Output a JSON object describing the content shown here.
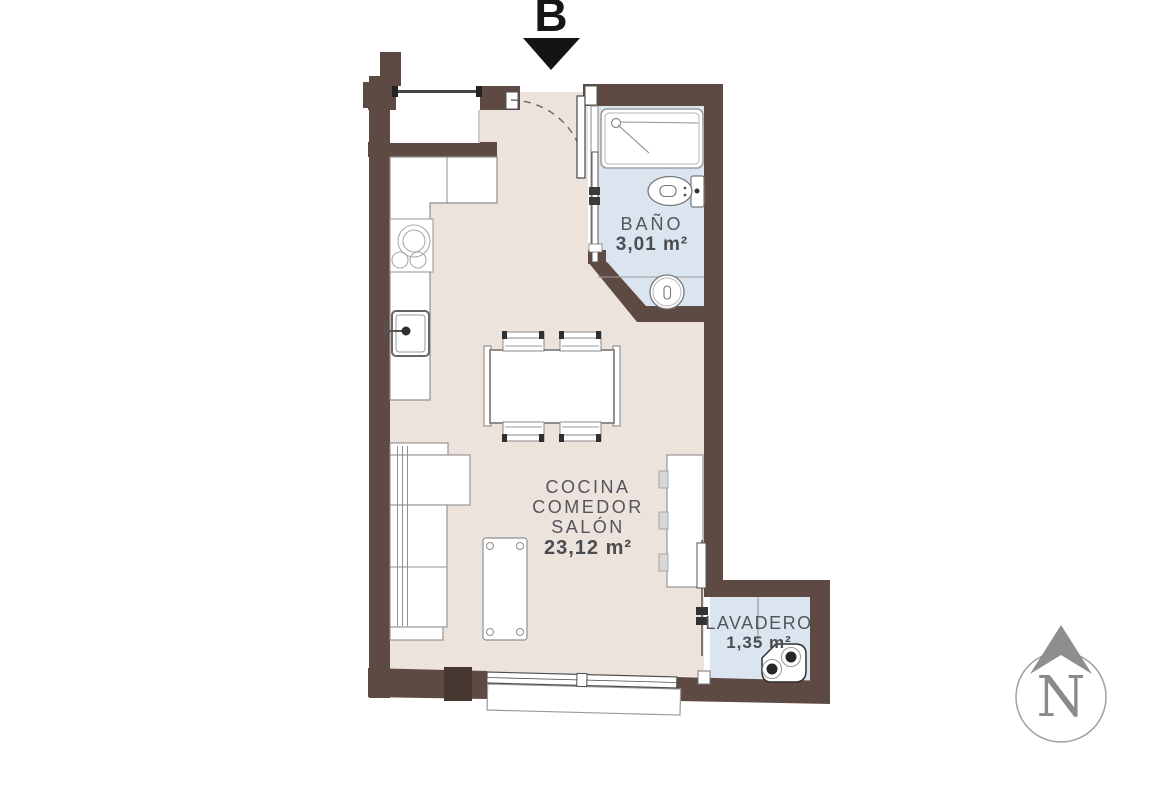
{
  "unit": {
    "label": "B"
  },
  "rooms": {
    "bathroom": {
      "name": "BAÑO",
      "area": "3,01 m²"
    },
    "living": {
      "line1": "COCINA",
      "line2": "COMEDOR",
      "line3": "SALÓN",
      "area": "23,12 m²"
    },
    "laundry": {
      "name": "LAVADERO",
      "area": "1,35 m²"
    }
  },
  "compass": {
    "label": "N"
  },
  "colors": {
    "wall": "#5d4a42",
    "wall_dark": "#463831",
    "floor_main": "#ece3dd",
    "floor_wet": "#dbe5f0",
    "black": "#141414",
    "compass_gray": "#8e8e8e",
    "text": "#54555a"
  },
  "fixtures": [
    "entrance-arrow",
    "kitchen-window",
    "door-swing",
    "entrance-door",
    "bathroom-sliding-door",
    "shower",
    "toilet",
    "washbasin",
    "kitchen-counter",
    "cooktop",
    "kitchen-sink",
    "dining-table",
    "chair",
    "sofa",
    "coffee-table",
    "tv-unit",
    "laundry-divider",
    "laundry-sliding-door",
    "washing-machine",
    "balcony-window",
    "window-sill",
    "north-compass"
  ]
}
